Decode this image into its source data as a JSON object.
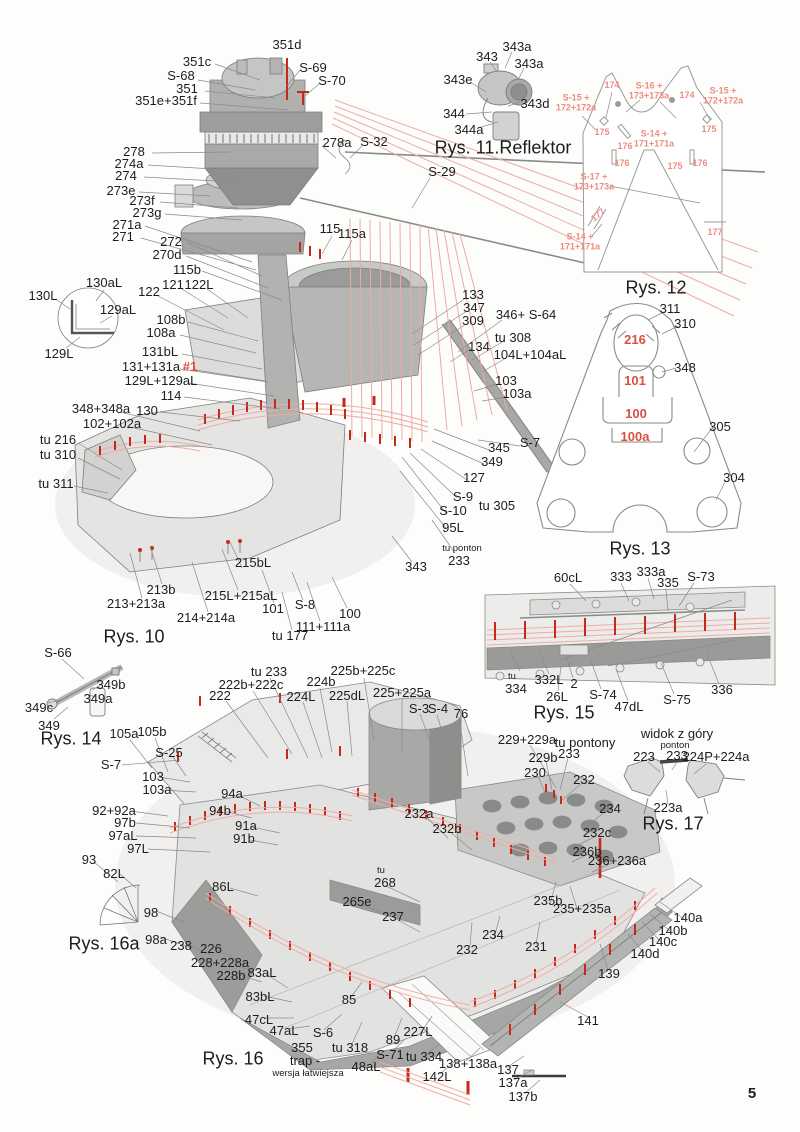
{
  "page": {
    "number": "5"
  },
  "colors": {
    "ink": "#1d1d1d",
    "red_label": "#d9503f",
    "red_label_light": "#ef8b80",
    "red_line": "#c5291a",
    "pink_line": "#f0a9a3",
    "outline_gray": "#8a8a8a"
  },
  "figures": [
    {
      "caption": "Rys. 10"
    },
    {
      "caption": "Rys. 11.Reflektor"
    },
    {
      "caption": "Rys. 12"
    },
    {
      "caption": "Rys. 13"
    },
    {
      "caption": "Rys. 14"
    },
    {
      "caption": "Rys. 15"
    },
    {
      "caption": "Rys. 16"
    },
    {
      "caption": "Rys. 16a"
    },
    {
      "caption": "Rys. 17"
    }
  ],
  "labels": [
    {
      "t": "351d",
      "x": 287,
      "y": 45
    },
    {
      "t": "351c",
      "x": 197,
      "y": 62
    },
    {
      "t": "S-68",
      "x": 181,
      "y": 76
    },
    {
      "t": "351",
      "x": 187,
      "y": 89
    },
    {
      "t": "351e+351f",
      "x": 166,
      "y": 101
    },
    {
      "t": "S-69",
      "x": 313,
      "y": 68
    },
    {
      "t": "S-70",
      "x": 332,
      "y": 81
    },
    {
      "t": "278a",
      "x": 337,
      "y": 143
    },
    {
      "t": "S-32",
      "x": 374,
      "y": 142
    },
    {
      "t": "S-29",
      "x": 442,
      "y": 172
    },
    {
      "t": "278",
      "x": 134,
      "y": 152
    },
    {
      "t": "274a",
      "x": 129,
      "y": 164
    },
    {
      "t": "274",
      "x": 126,
      "y": 176
    },
    {
      "t": "273e",
      "x": 121,
      "y": 191
    },
    {
      "t": "273f",
      "x": 142,
      "y": 201
    },
    {
      "t": "273g",
      "x": 147,
      "y": 213
    },
    {
      "t": "271a",
      "x": 127,
      "y": 225
    },
    {
      "t": "271",
      "x": 123,
      "y": 237
    },
    {
      "t": "272",
      "x": 171,
      "y": 242
    },
    {
      "t": "270d",
      "x": 167,
      "y": 255
    },
    {
      "t": "115b",
      "x": 187,
      "y": 270
    },
    {
      "t": "115",
      "x": 330,
      "y": 229
    },
    {
      "t": "115a",
      "x": 352,
      "y": 234
    },
    {
      "t": "121",
      "x": 173,
      "y": 285
    },
    {
      "t": "122L",
      "x": 199,
      "y": 285
    },
    {
      "t": "122",
      "x": 149,
      "y": 292
    },
    {
      "t": "343",
      "x": 487,
      "y": 57
    },
    {
      "t": "343a",
      "x": 517,
      "y": 47
    },
    {
      "t": "343a",
      "x": 529,
      "y": 64
    },
    {
      "t": "343e",
      "x": 458,
      "y": 80
    },
    {
      "t": "343d",
      "x": 535,
      "y": 104
    },
    {
      "t": "344",
      "x": 454,
      "y": 114
    },
    {
      "t": "344a",
      "x": 469,
      "y": 130
    },
    {
      "t": "Rys. 11.Reflektor",
      "x": 503,
      "y": 148,
      "c": "caption"
    },
    {
      "t": "S-15 +\n172+172a",
      "x": 576,
      "y": 103,
      "c": "redsm"
    },
    {
      "t": "174",
      "x": 612,
      "y": 85,
      "c": "redsm"
    },
    {
      "t": "S-16 +\n173+173a",
      "x": 649,
      "y": 91,
      "c": "redsm"
    },
    {
      "t": "174",
      "x": 687,
      "y": 95,
      "c": "redsm"
    },
    {
      "t": "S-15 +\n172+172a",
      "x": 723,
      "y": 96,
      "c": "redsm"
    },
    {
      "t": "175",
      "x": 602,
      "y": 132,
      "c": "redsm"
    },
    {
      "t": "175",
      "x": 709,
      "y": 129,
      "c": "redsm"
    },
    {
      "t": "S-14 +\n171+171a",
      "x": 654,
      "y": 139,
      "c": "redsm"
    },
    {
      "t": "176",
      "x": 625,
      "y": 146,
      "c": "redsm"
    },
    {
      "t": "176",
      "x": 622,
      "y": 163,
      "c": "redsm"
    },
    {
      "t": "175",
      "x": 675,
      "y": 166,
      "c": "redsm"
    },
    {
      "t": "176",
      "x": 700,
      "y": 163,
      "c": "redsm"
    },
    {
      "t": "S-17 +\n173+173a",
      "x": 594,
      "y": 182,
      "c": "redsm"
    },
    {
      "t": "177",
      "x": 598,
      "y": 215,
      "c": "redsm",
      "r": -38
    },
    {
      "t": "S-14 +\n171+171a",
      "x": 580,
      "y": 242,
      "c": "redsm"
    },
    {
      "t": "177",
      "x": 715,
      "y": 232,
      "c": "redsm"
    },
    {
      "t": "Rys. 12",
      "x": 656,
      "y": 288,
      "c": "caption"
    },
    {
      "t": "130aL",
      "x": 104,
      "y": 283
    },
    {
      "t": "130L",
      "x": 43,
      "y": 296
    },
    {
      "t": "129aL",
      "x": 118,
      "y": 310
    },
    {
      "t": "129L",
      "x": 59,
      "y": 354
    },
    {
      "t": "108b",
      "x": 171,
      "y": 320
    },
    {
      "t": "108a",
      "x": 161,
      "y": 333
    },
    {
      "t": "131bL",
      "x": 160,
      "y": 352
    },
    {
      "t": "131+131a",
      "x": 151,
      "y": 367
    },
    {
      "t": "#1",
      "x": 190,
      "y": 367,
      "c": "red"
    },
    {
      "t": "129L+129aL",
      "x": 161,
      "y": 381
    },
    {
      "t": "114",
      "x": 171,
      "y": 396
    },
    {
      "t": "130",
      "x": 147,
      "y": 411
    },
    {
      "t": "348+348a",
      "x": 101,
      "y": 409
    },
    {
      "t": "102+102a",
      "x": 112,
      "y": 424
    },
    {
      "t": "tu 216",
      "x": 58,
      "y": 440
    },
    {
      "t": "tu 310",
      "x": 58,
      "y": 455
    },
    {
      "t": "tu 311",
      "x": 56,
      "y": 484
    },
    {
      "t": "133",
      "x": 473,
      "y": 295
    },
    {
      "t": "347",
      "x": 474,
      "y": 308
    },
    {
      "t": "309",
      "x": 473,
      "y": 321
    },
    {
      "t": "346+ S-64",
      "x": 526,
      "y": 315
    },
    {
      "t": "tu 308",
      "x": 513,
      "y": 338
    },
    {
      "t": "134",
      "x": 479,
      "y": 347
    },
    {
      "t": "104L+104aL",
      "x": 530,
      "y": 355
    },
    {
      "t": "103",
      "x": 506,
      "y": 381
    },
    {
      "t": "103a",
      "x": 517,
      "y": 394
    },
    {
      "t": "311",
      "x": 670,
      "y": 309
    },
    {
      "t": "310",
      "x": 685,
      "y": 324
    },
    {
      "t": "216",
      "x": 635,
      "y": 340,
      "c": "red"
    },
    {
      "t": "348",
      "x": 685,
      "y": 368
    },
    {
      "t": "101",
      "x": 635,
      "y": 381,
      "c": "red"
    },
    {
      "t": "100",
      "x": 636,
      "y": 414,
      "c": "red"
    },
    {
      "t": "100a",
      "x": 635,
      "y": 437,
      "c": "red"
    },
    {
      "t": "305",
      "x": 720,
      "y": 427
    },
    {
      "t": "304",
      "x": 734,
      "y": 478
    },
    {
      "t": "Rys. 13",
      "x": 640,
      "y": 549,
      "c": "caption"
    },
    {
      "t": "345",
      "x": 499,
      "y": 448
    },
    {
      "t": "S-7",
      "x": 530,
      "y": 443
    },
    {
      "t": "349",
      "x": 492,
      "y": 462
    },
    {
      "t": "127",
      "x": 474,
      "y": 478
    },
    {
      "t": "S-9",
      "x": 463,
      "y": 497
    },
    {
      "t": "tu 305",
      "x": 497,
      "y": 506
    },
    {
      "t": "S-10",
      "x": 453,
      "y": 511
    },
    {
      "t": "95L",
      "x": 453,
      "y": 528
    },
    {
      "t": "tu ponton",
      "x": 462,
      "y": 549,
      "c": "small"
    },
    {
      "t": "233",
      "x": 459,
      "y": 561
    },
    {
      "t": "343",
      "x": 416,
      "y": 567
    },
    {
      "t": "213b",
      "x": 161,
      "y": 590
    },
    {
      "t": "213+213a",
      "x": 136,
      "y": 604
    },
    {
      "t": "215bL",
      "x": 253,
      "y": 563
    },
    {
      "t": "215L+215aL",
      "x": 241,
      "y": 596
    },
    {
      "t": "214+214a",
      "x": 206,
      "y": 618
    },
    {
      "t": "101",
      "x": 273,
      "y": 609
    },
    {
      "t": "S-8",
      "x": 305,
      "y": 605
    },
    {
      "t": "100",
      "x": 350,
      "y": 614
    },
    {
      "t": "111+111a",
      "x": 323,
      "y": 627
    },
    {
      "t": "tu 177",
      "x": 290,
      "y": 636
    },
    {
      "t": "Rys. 10",
      "x": 134,
      "y": 637,
      "c": "caption"
    },
    {
      "t": "60cL",
      "x": 568,
      "y": 578
    },
    {
      "t": "333",
      "x": 621,
      "y": 577
    },
    {
      "t": "333a",
      "x": 651,
      "y": 572
    },
    {
      "t": "335",
      "x": 668,
      "y": 583
    },
    {
      "t": "S-73",
      "x": 701,
      "y": 577
    },
    {
      "t": "tu",
      "x": 512,
      "y": 677,
      "c": "small"
    },
    {
      "t": "334",
      "x": 516,
      "y": 689
    },
    {
      "t": "332L",
      "x": 549,
      "y": 680
    },
    {
      "t": "2",
      "x": 574,
      "y": 684
    },
    {
      "t": "26L",
      "x": 557,
      "y": 697
    },
    {
      "t": "S-74",
      "x": 603,
      "y": 695
    },
    {
      "t": "47dL",
      "x": 629,
      "y": 707
    },
    {
      "t": "S-75",
      "x": 677,
      "y": 700
    },
    {
      "t": "336",
      "x": 722,
      "y": 690
    },
    {
      "t": "Rys. 15",
      "x": 564,
      "y": 713,
      "c": "caption"
    },
    {
      "t": "S-66",
      "x": 58,
      "y": 653
    },
    {
      "t": "349b",
      "x": 111,
      "y": 685
    },
    {
      "t": "349a",
      "x": 98,
      "y": 699
    },
    {
      "t": "349c",
      "x": 39,
      "y": 708
    },
    {
      "t": "349",
      "x": 49,
      "y": 726
    },
    {
      "t": "Rys. 14",
      "x": 71,
      "y": 739,
      "c": "caption"
    },
    {
      "t": "tu 233",
      "x": 269,
      "y": 672
    },
    {
      "t": "222b+222c",
      "x": 251,
      "y": 685
    },
    {
      "t": "222",
      "x": 220,
      "y": 696
    },
    {
      "t": "224b",
      "x": 321,
      "y": 682
    },
    {
      "t": "224L",
      "x": 301,
      "y": 697
    },
    {
      "t": "225dL",
      "x": 347,
      "y": 696
    },
    {
      "t": "225b+225c",
      "x": 363,
      "y": 671
    },
    {
      "t": "225+225a",
      "x": 402,
      "y": 693
    },
    {
      "t": "S-3",
      "x": 419,
      "y": 709
    },
    {
      "t": "S-4",
      "x": 438,
      "y": 709
    },
    {
      "t": "76",
      "x": 461,
      "y": 714
    },
    {
      "t": "105a",
      "x": 124,
      "y": 734
    },
    {
      "t": "105b",
      "x": 152,
      "y": 732
    },
    {
      "t": "S-25",
      "x": 169,
      "y": 753
    },
    {
      "t": "S-7",
      "x": 111,
      "y": 765
    },
    {
      "t": "103",
      "x": 153,
      "y": 777
    },
    {
      "t": "103a",
      "x": 157,
      "y": 790
    },
    {
      "t": "94a",
      "x": 232,
      "y": 794
    },
    {
      "t": "94b",
      "x": 220,
      "y": 811
    },
    {
      "t": "92+92a",
      "x": 114,
      "y": 811
    },
    {
      "t": "97b",
      "x": 125,
      "y": 823
    },
    {
      "t": "97aL",
      "x": 123,
      "y": 836
    },
    {
      "t": "97L",
      "x": 138,
      "y": 849
    },
    {
      "t": "91a",
      "x": 246,
      "y": 826
    },
    {
      "t": "91b",
      "x": 244,
      "y": 839
    },
    {
      "t": "93",
      "x": 89,
      "y": 860
    },
    {
      "t": "82L",
      "x": 114,
      "y": 874
    },
    {
      "t": "86L",
      "x": 223,
      "y": 887
    },
    {
      "t": "98",
      "x": 151,
      "y": 913
    },
    {
      "t": "98a",
      "x": 156,
      "y": 940
    },
    {
      "t": "Rys. 16a",
      "x": 104,
      "y": 944,
      "c": "caption"
    },
    {
      "t": "238",
      "x": 181,
      "y": 946
    },
    {
      "t": "226",
      "x": 211,
      "y": 949
    },
    {
      "t": "228+228a",
      "x": 220,
      "y": 963
    },
    {
      "t": "228b",
      "x": 231,
      "y": 976
    },
    {
      "t": "83aL",
      "x": 262,
      "y": 973
    },
    {
      "t": "83bL",
      "x": 260,
      "y": 997
    },
    {
      "t": "47cL",
      "x": 259,
      "y": 1020
    },
    {
      "t": "47aL",
      "x": 284,
      "y": 1031
    },
    {
      "t": "S-6",
      "x": 323,
      "y": 1033
    },
    {
      "t": "355",
      "x": 302,
      "y": 1048
    },
    {
      "t": "trap -",
      "x": 305,
      "y": 1061
    },
    {
      "t": "wersja łatwiejsza",
      "x": 308,
      "y": 1074,
      "c": "small"
    },
    {
      "t": "Rys. 16",
      "x": 233,
      "y": 1059,
      "c": "caption"
    },
    {
      "t": "85",
      "x": 349,
      "y": 1000
    },
    {
      "t": "tu 318",
      "x": 350,
      "y": 1048
    },
    {
      "t": "89",
      "x": 393,
      "y": 1040
    },
    {
      "t": "S-71",
      "x": 390,
      "y": 1055
    },
    {
      "t": "48aL",
      "x": 366,
      "y": 1067
    },
    {
      "t": "227L",
      "x": 418,
      "y": 1032
    },
    {
      "t": "tu 334",
      "x": 424,
      "y": 1057
    },
    {
      "t": "138+138a",
      "x": 468,
      "y": 1064
    },
    {
      "t": "142L",
      "x": 437,
      "y": 1077
    },
    {
      "t": "137",
      "x": 508,
      "y": 1070
    },
    {
      "t": "137a",
      "x": 513,
      "y": 1083
    },
    {
      "t": "137b",
      "x": 523,
      "y": 1097
    },
    {
      "t": "229+229a",
      "x": 527,
      "y": 740
    },
    {
      "t": "tu pontony",
      "x": 585,
      "y": 743
    },
    {
      "t": "233",
      "x": 569,
      "y": 754
    },
    {
      "t": "229b",
      "x": 543,
      "y": 758
    },
    {
      "t": "230",
      "x": 535,
      "y": 773
    },
    {
      "t": "232",
      "x": 584,
      "y": 780
    },
    {
      "t": "234",
      "x": 610,
      "y": 809
    },
    {
      "t": "232c",
      "x": 597,
      "y": 833
    },
    {
      "t": "236b",
      "x": 587,
      "y": 852
    },
    {
      "t": "236+236a",
      "x": 617,
      "y": 861
    },
    {
      "t": "232a",
      "x": 419,
      "y": 814
    },
    {
      "t": "232b",
      "x": 447,
      "y": 829
    },
    {
      "t": "tu",
      "x": 381,
      "y": 871,
      "c": "small"
    },
    {
      "t": "268",
      "x": 385,
      "y": 883
    },
    {
      "t": "265e",
      "x": 357,
      "y": 902
    },
    {
      "t": "237",
      "x": 393,
      "y": 917
    },
    {
      "t": "232",
      "x": 467,
      "y": 950
    },
    {
      "t": "234",
      "x": 493,
      "y": 935
    },
    {
      "t": "231",
      "x": 536,
      "y": 947
    },
    {
      "t": "235b",
      "x": 548,
      "y": 901
    },
    {
      "t": "235+235a",
      "x": 582,
      "y": 909
    },
    {
      "t": "139",
      "x": 609,
      "y": 974
    },
    {
      "t": "140a",
      "x": 688,
      "y": 918
    },
    {
      "t": "140b",
      "x": 673,
      "y": 931
    },
    {
      "t": "140c",
      "x": 663,
      "y": 942
    },
    {
      "t": "140d",
      "x": 645,
      "y": 954
    },
    {
      "t": "141",
      "x": 588,
      "y": 1021
    },
    {
      "t": "widok z góry",
      "x": 677,
      "y": 734
    },
    {
      "t": "ponton",
      "x": 675,
      "y": 746,
      "c": "small"
    },
    {
      "t": "223",
      "x": 644,
      "y": 757
    },
    {
      "t": "233",
      "x": 677,
      "y": 756
    },
    {
      "t": "224P+224a",
      "x": 716,
      "y": 757
    },
    {
      "t": "223a",
      "x": 668,
      "y": 808
    },
    {
      "t": "Rys. 17",
      "x": 673,
      "y": 824,
      "c": "caption"
    }
  ]
}
